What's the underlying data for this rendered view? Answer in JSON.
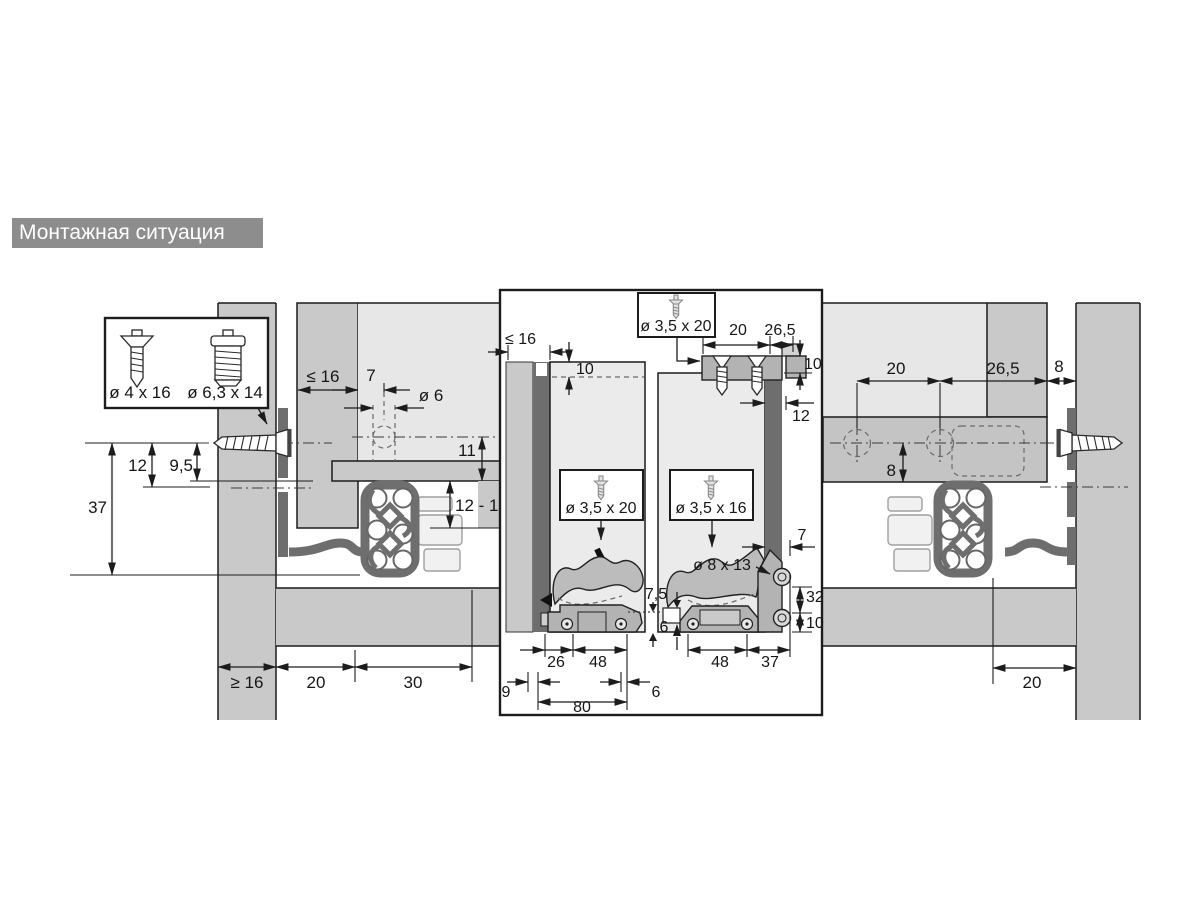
{
  "title": "Монтажная ситуация",
  "left": {
    "screw_box": {
      "screw1": "ø 4 x 16",
      "screw2": "ø 6,3 x 14"
    },
    "dims": {
      "rear_gap": "≤ 16",
      "front_offset": "7",
      "hole": "ø 6",
      "h11": "11",
      "h1213": "12 - 13",
      "d37": "37",
      "d12": "12",
      "d95": "9,5",
      "panel_min": "≥ 16",
      "b20": "20",
      "b30": "30"
    }
  },
  "center": {
    "screws": {
      "top": "ø 3,5 x 20",
      "left": "ø 3,5 x 20",
      "right": "ø 3,5 x 16",
      "hole": "ø 8 x 13"
    },
    "dims": {
      "panel_max": "≤ 16",
      "inset10": "10",
      "top20": "20",
      "top265": "26,5",
      "right10": "10",
      "strip12": "12",
      "gap75": "7,5",
      "gap6": "6",
      "r26": "26",
      "r48": "48",
      "r9": "9",
      "r6": "6",
      "r80": "80",
      "q48": "48",
      "q37": "37",
      "q7": "7",
      "q32": "32",
      "q10": "10"
    }
  },
  "right": {
    "dims": {
      "t20": "20",
      "t265": "26,5",
      "t8": "8",
      "v8": "8",
      "b20": "20"
    }
  }
}
